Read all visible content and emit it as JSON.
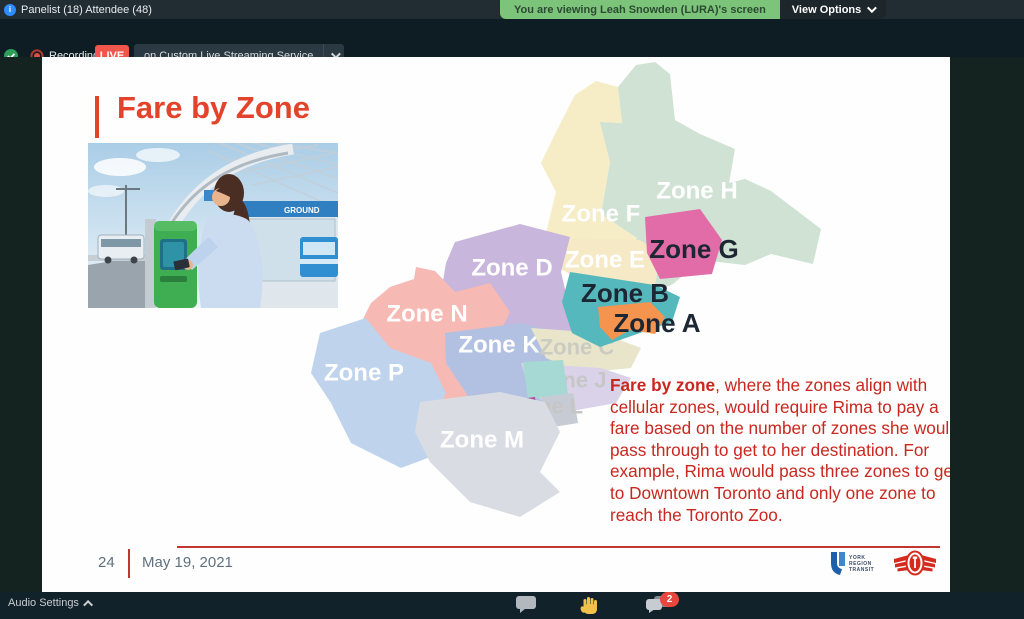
{
  "top_bar": {
    "participants_label": "Panelist (18) Attendee (48)",
    "viewing_banner": "You are viewing Leah Snowden (LURA)'s screen",
    "view_options_label": "View Options"
  },
  "recording_bar": {
    "recording_label": "Recording",
    "live_badge": "LIVE",
    "stream_service_label": "on Custom Live Streaming Service"
  },
  "bottom_bar": {
    "audio_settings_label": "Audio Settings",
    "chat_badge_count": "2"
  },
  "slide": {
    "title": "Fare by Zone",
    "photo_sign_text": "GROUND",
    "body": {
      "lead_bold": "Fare by zone",
      "rest": ", where the zones align with cellular zones, would require Rima to pay a fare based on the number of zones she would pass through to get to her destination. For example, Rima would pass three zones to get to Downtown Toronto and only one zone to reach the Toronto Zoo."
    },
    "page_number": "24",
    "date": "May 19, 2021",
    "footer_logos": {
      "yrt_lines": [
        "YORK",
        "REGION",
        "TRANSIT"
      ]
    }
  },
  "colors": {
    "title_red": "#e3422b",
    "body_red": "#c9271f",
    "accent_line_red": "#c23531",
    "live_red": "#f0564b",
    "banner_green": "#7bc479",
    "zone_l_accent": "#af4fa3",
    "zone_l_gray": "#c7cbd4"
  },
  "map": {
    "zones": [
      {
        "id": "H",
        "label": "Zone H",
        "fill": "#cfe2d3",
        "label_fill": "#ffffff",
        "label_size": 24
      },
      {
        "id": "F",
        "label": "Zone F",
        "fill": "#f6ecc5",
        "label_fill": "#ffffff",
        "label_size": 24
      },
      {
        "id": "E",
        "label": "Zone E",
        "fill": "#f5e9c6",
        "label_fill": "#ffffff",
        "label_size": 24
      },
      {
        "id": "D",
        "label": "Zone D",
        "fill": "#c8b6dc",
        "label_fill": "#ffffff",
        "label_size": 24
      },
      {
        "id": "N",
        "label": "Zone N",
        "fill": "#f6b9b3",
        "label_fill": "#ffffff",
        "label_size": 24
      },
      {
        "id": "P",
        "label": "Zone P",
        "fill": "#bfd3ec",
        "label_fill": "#ffffff",
        "label_size": 24
      },
      {
        "id": "K",
        "label": "Zone K",
        "fill": "#b2c1e1",
        "label_fill": "#ffffff",
        "label_size": 24
      },
      {
        "id": "C",
        "label": "Zone C",
        "fill": "#e9e5cb",
        "label_fill": "#cbcbc2",
        "label_size": 22
      },
      {
        "id": "J",
        "label": "Zone J",
        "fill": "#d9d2e9",
        "label_fill": "#c6c6c6",
        "label_size": 22
      },
      {
        "id": "L",
        "label": "Zone L",
        "fill": "#a6d9d3",
        "label_fill": "#c6c6c6",
        "label_size": 22
      },
      {
        "id": "M",
        "label": "Zone M",
        "fill": "#d9dde3",
        "label_fill": "#ffffff",
        "label_size": 24
      },
      {
        "id": "G",
        "label": "Zone G",
        "fill": "#e26ca8",
        "label_fill": "#1d2733",
        "label_size": 26
      },
      {
        "id": "B",
        "label": "Zone B",
        "fill": "#55b8bd",
        "label_fill": "#1d2733",
        "label_size": 26
      },
      {
        "id": "A",
        "label": "Zone A",
        "fill": "#f4944f",
        "label_fill": "#1d2733",
        "label_size": 26
      }
    ]
  }
}
